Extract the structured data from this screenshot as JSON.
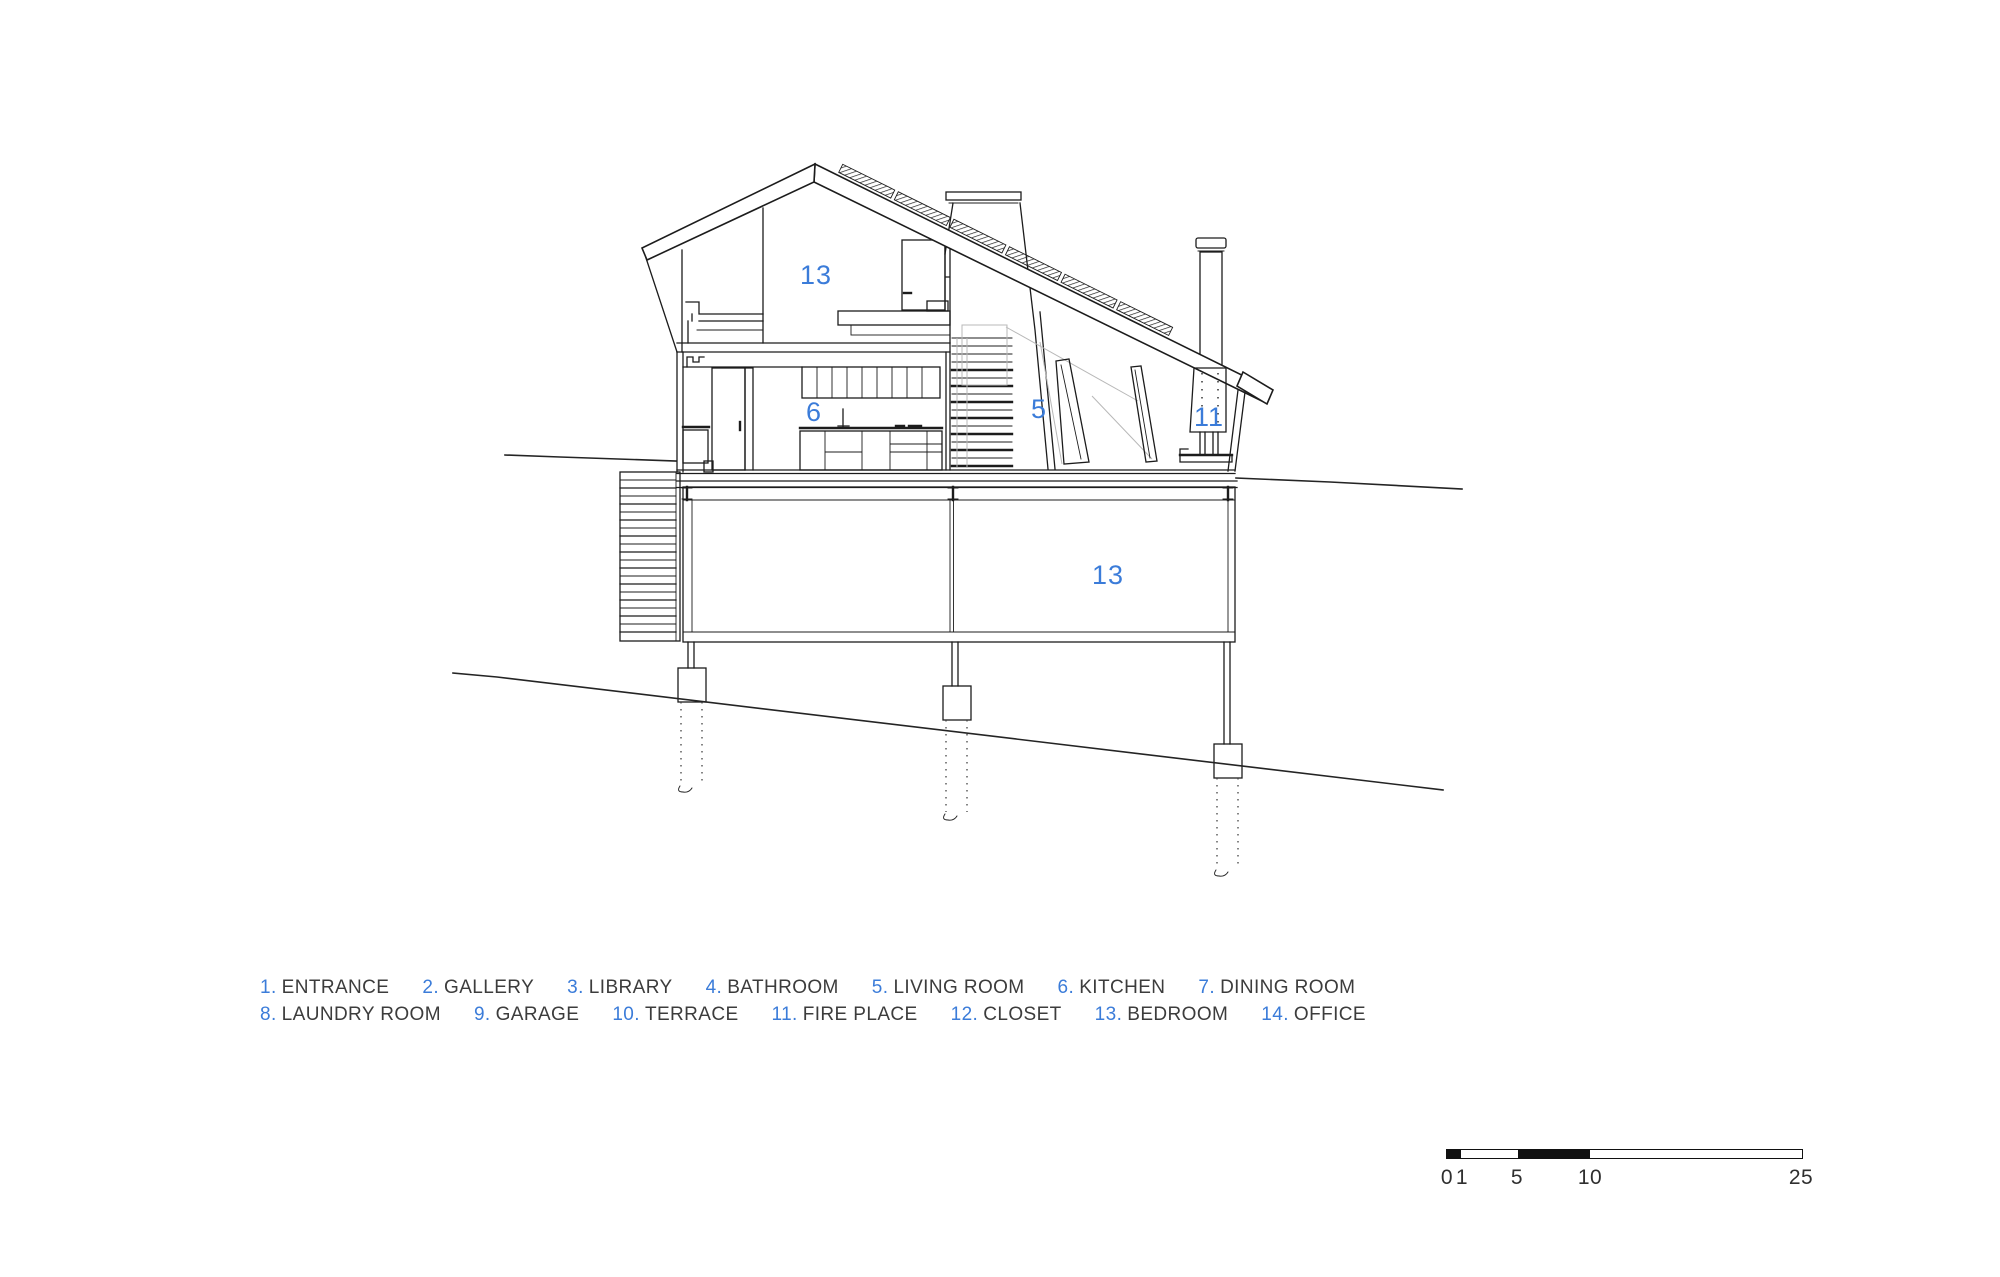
{
  "colors": {
    "accent": "#3b7cd9",
    "ink": "#3c3c3c",
    "line": "#1c1c1c"
  },
  "drawing": {
    "type": "architectural-cross-section",
    "room_labels": [
      {
        "value": "13",
        "x": 800,
        "y": 284
      },
      {
        "value": "6",
        "x": 806,
        "y": 421
      },
      {
        "value": "5",
        "x": 1031,
        "y": 418
      },
      {
        "value": "11",
        "x": 1194,
        "y": 426
      },
      {
        "value": "13",
        "x": 1092,
        "y": 584
      }
    ]
  },
  "legend": {
    "items": [
      {
        "num": "1.",
        "name": "ENTRANCE"
      },
      {
        "num": "2.",
        "name": "GALLERY"
      },
      {
        "num": "3.",
        "name": "LIBRARY"
      },
      {
        "num": "4.",
        "name": "BATHROOM"
      },
      {
        "num": "5.",
        "name": "LIVING ROOM"
      },
      {
        "num": "6.",
        "name": "KITCHEN"
      },
      {
        "num": "7.",
        "name": "DINING ROOM"
      },
      {
        "num": "8.",
        "name": "LAUNDRY ROOM"
      },
      {
        "num": "9.",
        "name": "GARAGE"
      },
      {
        "num": "10.",
        "name": "TERRACE"
      },
      {
        "num": "11.",
        "name": "FIRE PLACE"
      },
      {
        "num": "12.",
        "name": "CLOSET"
      },
      {
        "num": "13.",
        "name": "BEDROOM"
      },
      {
        "num": "14.",
        "name": "OFFICE"
      }
    ]
  },
  "scalebar": {
    "labels": [
      {
        "text": "0",
        "x": 1447
      },
      {
        "text": "1",
        "x": 1462
      },
      {
        "text": "5",
        "x": 1517
      },
      {
        "text": "10",
        "x": 1590
      },
      {
        "text": "25",
        "x": 1801
      }
    ]
  }
}
